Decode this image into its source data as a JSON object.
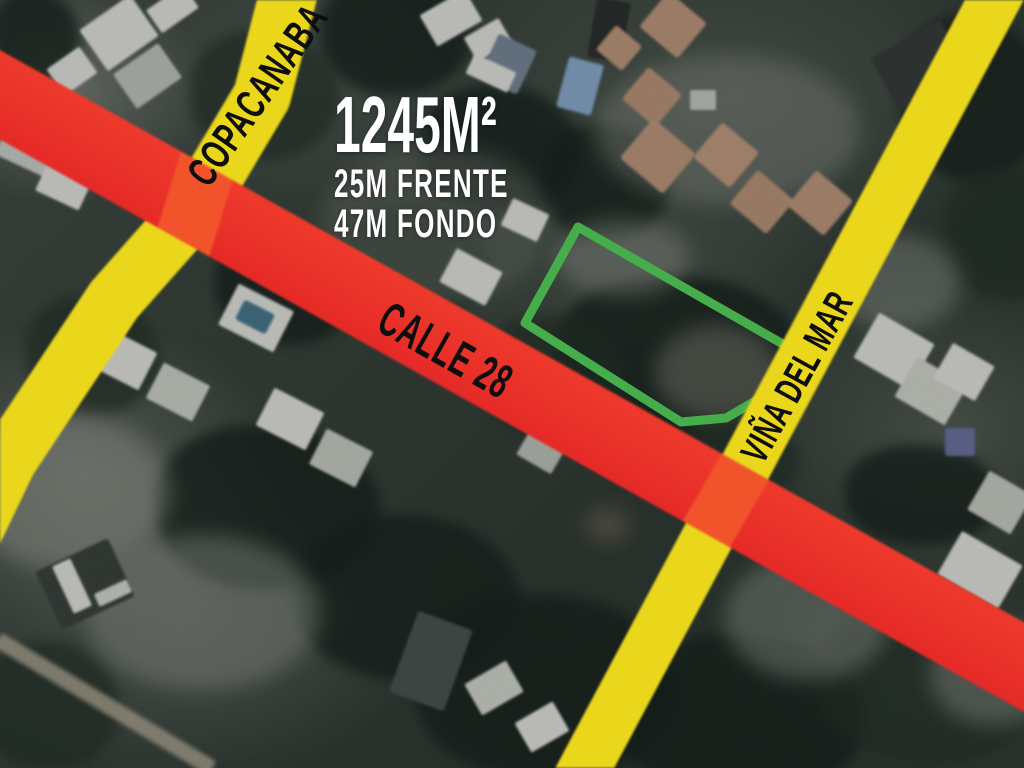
{
  "map": {
    "dimensions": {
      "area_label": "1245M²",
      "frontage_label": "25M FRENTE",
      "depth_label": "47M FONDO",
      "text_color": "#ffffff"
    },
    "streets": [
      {
        "id": "copacanaba",
        "label": "COPACANABA",
        "color": "#EAD71C"
      },
      {
        "id": "calle-28",
        "label": "CALLE 28",
        "color": "#EA2E28"
      },
      {
        "id": "vina-del-mar",
        "label": "VIÑA DEL MAR",
        "color": "#EAD71C"
      }
    ],
    "street_label_color": "#0e0e0e",
    "intersection_color": "#F1532B",
    "lot_outline_color": "#45AD4A"
  }
}
